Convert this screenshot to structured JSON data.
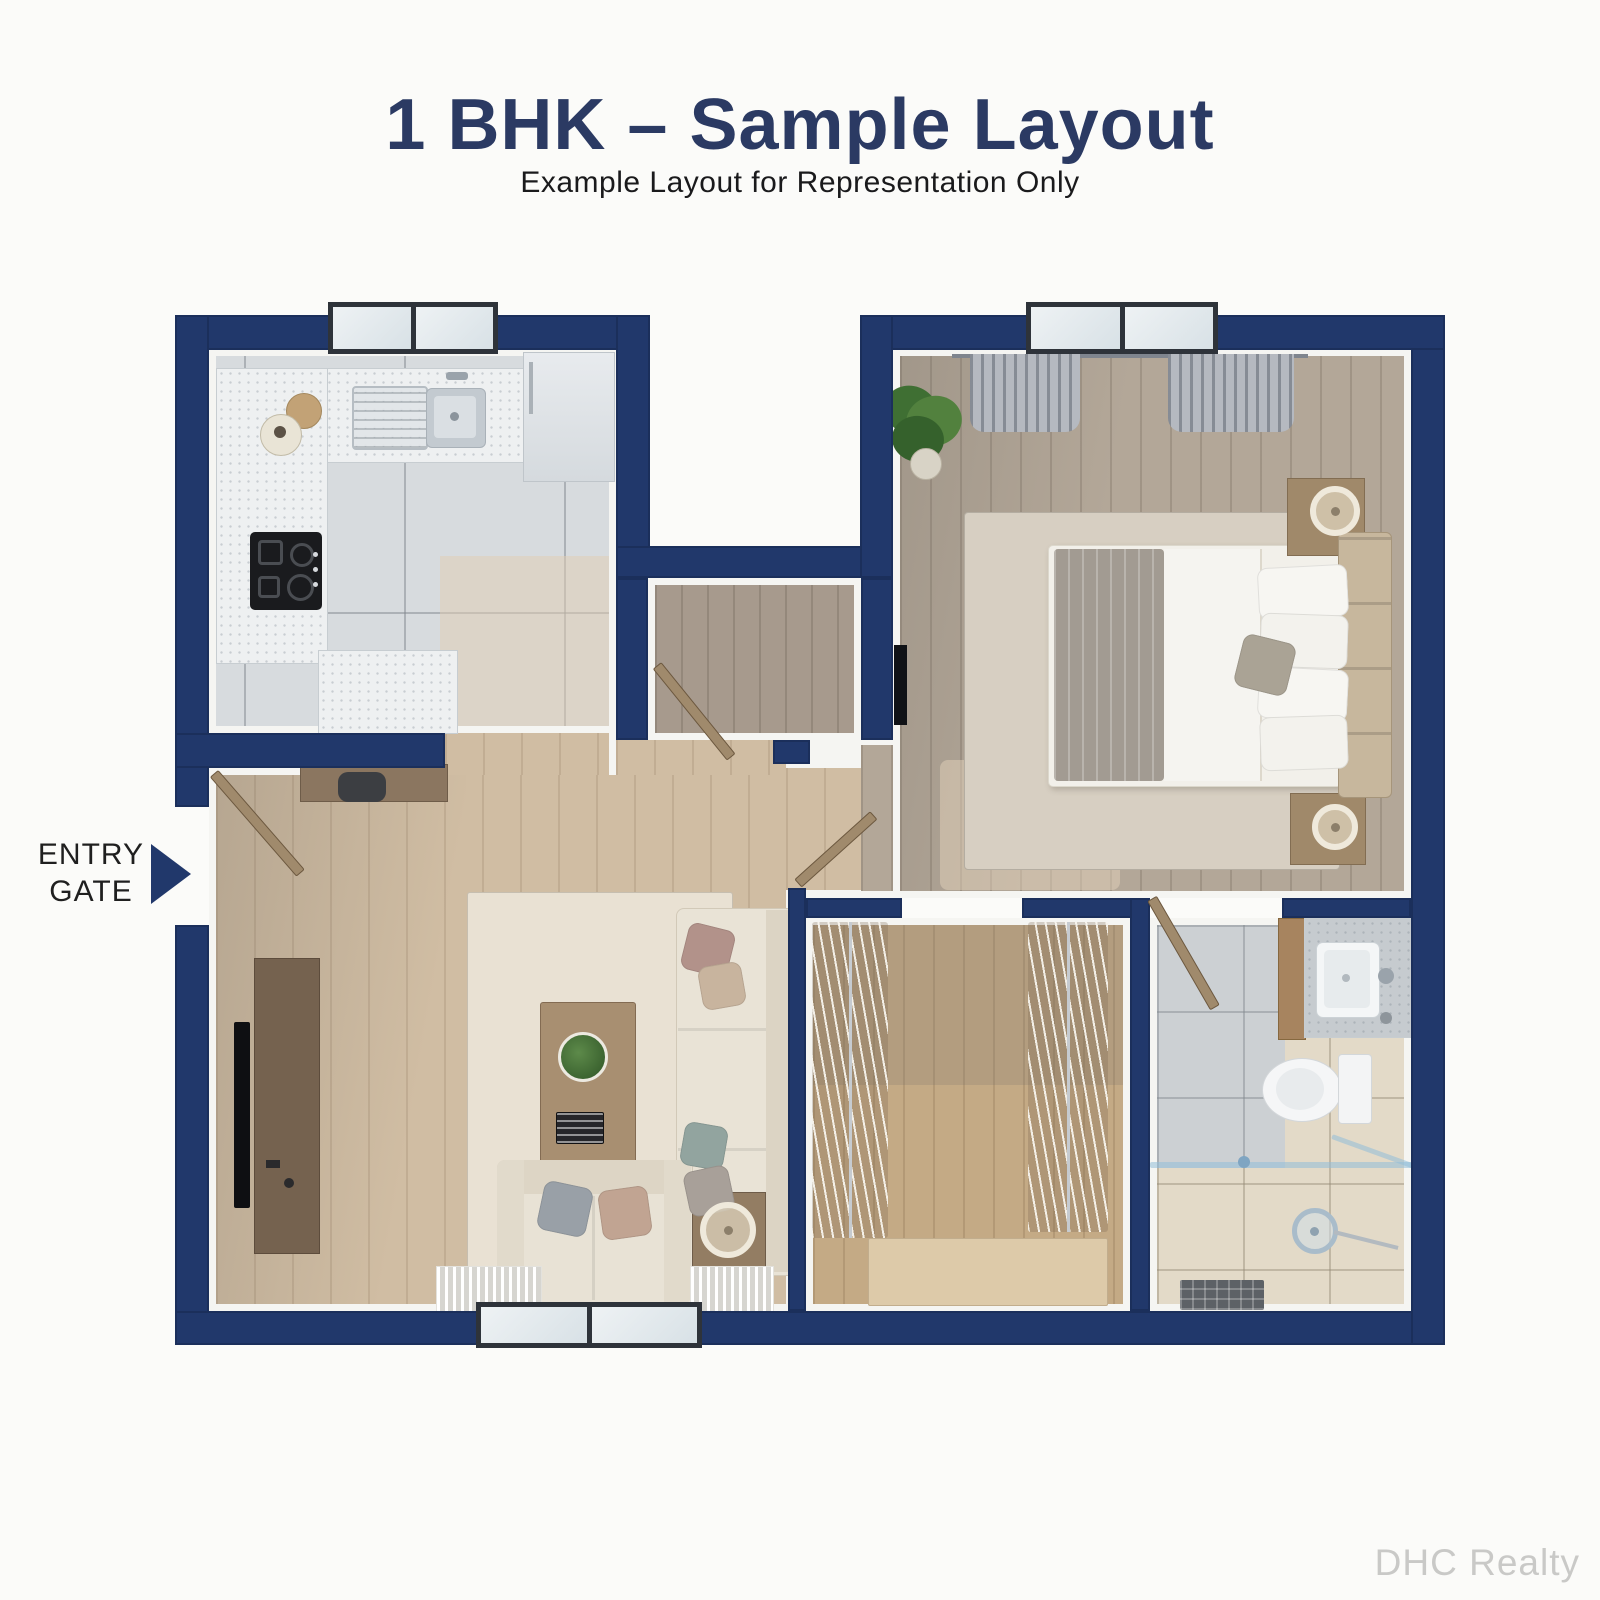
{
  "header": {
    "title": "1 BHK – Sample Layout",
    "subtitle": "Example Layout for Representation Only"
  },
  "entry_gate": {
    "line1": "ENTRY",
    "line2": "GATE",
    "icon": "right-arrow-icon"
  },
  "watermark": "DHC Realty",
  "colors": {
    "wall": "#21386b",
    "page_bg": "#fbfbf9",
    "title": "#2b3a63",
    "subtitle": "#1a1a1c",
    "watermark": "#c9c9c7"
  }
}
